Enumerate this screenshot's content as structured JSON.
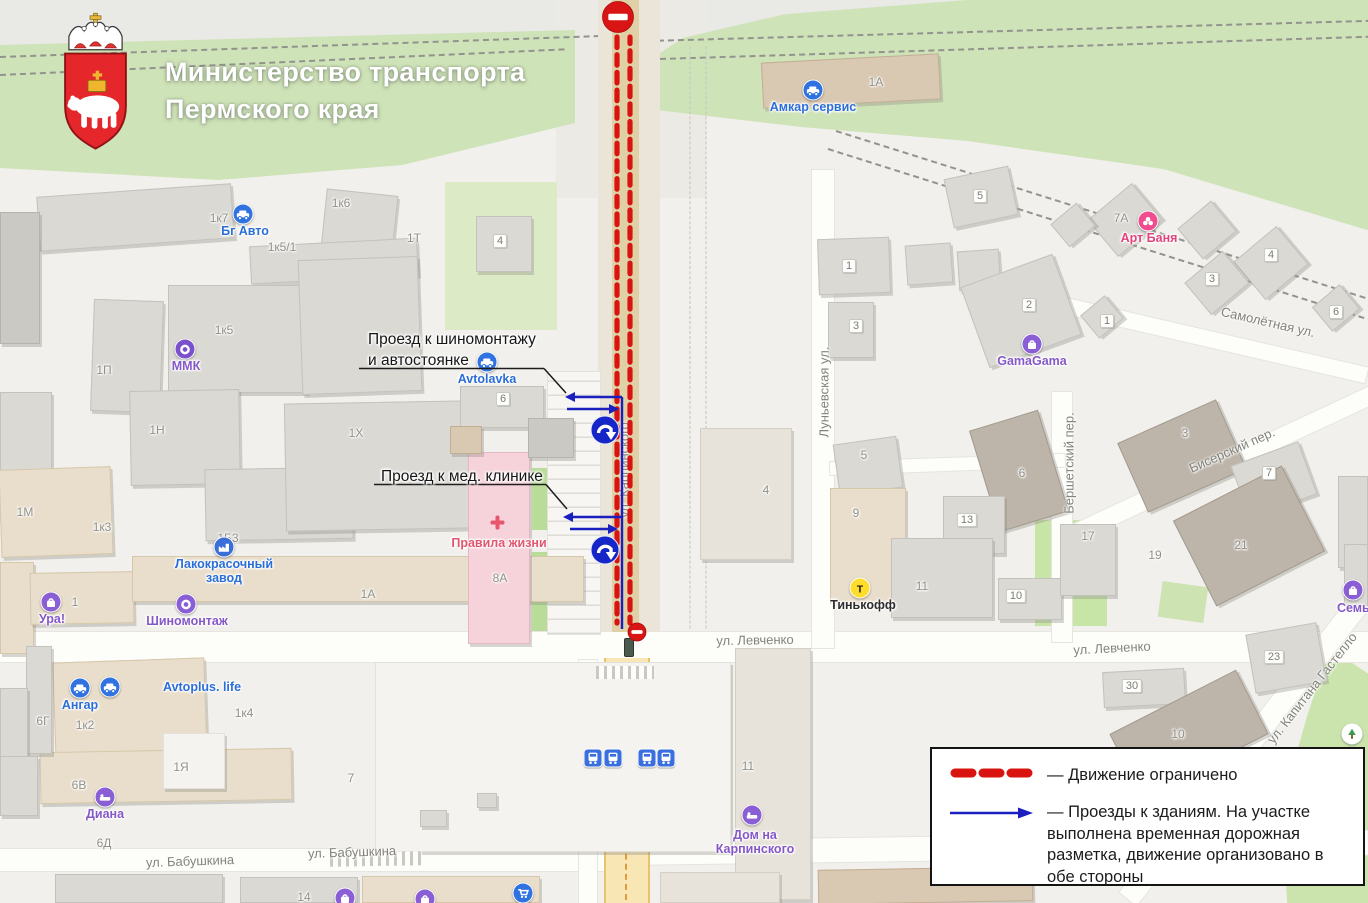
{
  "header": {
    "title_line1": "Министерство транспорта",
    "title_line2": "Пермского края",
    "emblem": "perm-krai-coat-of-arms"
  },
  "callouts": [
    {
      "lines": [
        "Проезд к шиномонтажу",
        "и автостоянке"
      ],
      "x": 368,
      "y": 329,
      "underline": [
        359,
        368.5,
        544,
        368.5
      ],
      "leader": [
        544,
        368.5,
        566,
        393
      ]
    },
    {
      "lines": [
        "Проезд к мед. клинике"
      ],
      "x": 381,
      "y": 466,
      "underline": [
        374,
        484.5,
        546,
        484.5
      ],
      "leader": [
        546,
        484.5,
        567,
        509
      ]
    }
  ],
  "legend": {
    "items": [
      {
        "symbol": "red-dashed-line",
        "label": "— Движение ограничено"
      },
      {
        "symbol": "blue-arrow",
        "label": "— Проезды к зданиям. На участке выполнена временная дорожная разметка, движение организовано в обе стороны"
      }
    ]
  },
  "colors": {
    "restricted": "#d91410",
    "access_route": "#1b1fc0",
    "sign_red": "#d81414",
    "legend_border": "#141414"
  },
  "closure": {
    "red_dash_lines": [
      {
        "x": 617,
        "y1": 37,
        "y2": 623
      },
      {
        "x": 630,
        "y1": 37,
        "y2": 623
      }
    ],
    "no_entry_signs": [
      {
        "x": 618,
        "y": 17,
        "r": 15.5
      },
      {
        "x": 637,
        "y": 632,
        "r": 9
      }
    ],
    "blue_guide_line": {
      "x": 622,
      "y1": 397,
      "y2": 629
    },
    "blue_arrows": [
      {
        "x1": 622,
        "y1": 397,
        "x2": 565,
        "y2": 397
      },
      {
        "x1": 567,
        "y1": 409,
        "x2": 619,
        "y2": 409
      },
      {
        "x1": 622,
        "y1": 517,
        "x2": 563,
        "y2": 517
      },
      {
        "x1": 570,
        "y1": 529,
        "x2": 618,
        "y2": 529
      }
    ],
    "turn_signs": [
      {
        "x": 605,
        "y": 430
      },
      {
        "x": 605,
        "y": 550
      }
    ]
  },
  "map": {
    "streets": [
      {
        "t": "ул. Левченко",
        "x": 755,
        "y": 640,
        "rot": -1
      },
      {
        "t": "ул. Левченко",
        "x": 1112,
        "y": 648,
        "rot": -3
      },
      {
        "t": "ул. Бабушкина",
        "x": 190,
        "y": 861,
        "rot": -2
      },
      {
        "t": "ул. Бабушкина",
        "x": 352,
        "y": 852,
        "rot": -2
      },
      {
        "t": "Самолётная ул.",
        "x": 1268,
        "y": 322,
        "rot": 13
      },
      {
        "t": "Луньевская ул.",
        "x": 824,
        "y": 392,
        "rot": -90
      },
      {
        "t": "Бершетский пер.",
        "x": 1069,
        "y": 463,
        "rot": -90
      },
      {
        "t": "Бисерский пер.",
        "x": 1232,
        "y": 450,
        "rot": -24
      },
      {
        "t": "ул. Капитана Гастелло",
        "x": 1312,
        "y": 688,
        "rot": -52
      },
      {
        "t": "ул. Карпинского",
        "x": 624,
        "y": 470,
        "rot": -90
      }
    ],
    "addresses": [
      {
        "t": "1к7",
        "x": 219,
        "y": 218
      },
      {
        "t": "1к6",
        "x": 341,
        "y": 203
      },
      {
        "t": "1Т",
        "x": 414,
        "y": 238
      },
      {
        "t": "1к5/1",
        "x": 282,
        "y": 247
      },
      {
        "t": "1к5",
        "x": 224,
        "y": 330
      },
      {
        "t": "1П",
        "x": 104,
        "y": 370
      },
      {
        "t": "1Н",
        "x": 157,
        "y": 430
      },
      {
        "t": "1Х",
        "x": 356,
        "y": 433
      },
      {
        "t": "1М",
        "x": 25,
        "y": 512
      },
      {
        "t": "1к3",
        "x": 102,
        "y": 527
      },
      {
        "t": "1Б3",
        "x": 228,
        "y": 538
      },
      {
        "t": "8А",
        "x": 500,
        "y": 578
      },
      {
        "t": "1А",
        "x": 368,
        "y": 594
      },
      {
        "t": "1",
        "x": 75,
        "y": 602
      },
      {
        "t": "6",
        "x": 503,
        "y": 399,
        "p": 1
      },
      {
        "t": "4",
        "x": 500,
        "y": 241,
        "p": 1
      },
      {
        "t": "1А",
        "x": 876,
        "y": 82
      },
      {
        "t": "5",
        "x": 980,
        "y": 196,
        "p": 1
      },
      {
        "t": "1",
        "x": 849,
        "y": 266,
        "p": 1
      },
      {
        "t": "3",
        "x": 856,
        "y": 326,
        "p": 1
      },
      {
        "t": "2",
        "x": 1029,
        "y": 305,
        "p": 1
      },
      {
        "t": "1",
        "x": 1107,
        "y": 321,
        "p": 1
      },
      {
        "t": "7А",
        "x": 1121,
        "y": 218
      },
      {
        "t": "4",
        "x": 1271,
        "y": 255,
        "p": 1
      },
      {
        "t": "3",
        "x": 1212,
        "y": 279,
        "p": 1
      },
      {
        "t": "6",
        "x": 1336,
        "y": 312,
        "p": 1
      },
      {
        "t": "4",
        "x": 766,
        "y": 490
      },
      {
        "t": "5",
        "x": 864,
        "y": 455
      },
      {
        "t": "6",
        "x": 1022,
        "y": 473
      },
      {
        "t": "9",
        "x": 856,
        "y": 513
      },
      {
        "t": "13",
        "x": 967,
        "y": 520,
        "p": 1
      },
      {
        "t": "11",
        "x": 922,
        "y": 586
      },
      {
        "t": "10",
        "x": 1016,
        "y": 596,
        "p": 1
      },
      {
        "t": "17",
        "x": 1088,
        "y": 536
      },
      {
        "t": "19",
        "x": 1155,
        "y": 555
      },
      {
        "t": "21",
        "x": 1241,
        "y": 545
      },
      {
        "t": "3",
        "x": 1185,
        "y": 433
      },
      {
        "t": "7",
        "x": 1269,
        "y": 473,
        "p": 1
      },
      {
        "t": "23",
        "x": 1274,
        "y": 657,
        "p": 1
      },
      {
        "t": "30",
        "x": 1132,
        "y": 686,
        "p": 1
      },
      {
        "t": "10",
        "x": 1178,
        "y": 734
      },
      {
        "t": "11",
        "x": 748,
        "y": 766
      },
      {
        "t": "6Г",
        "x": 43,
        "y": 721
      },
      {
        "t": "1к2",
        "x": 85,
        "y": 725
      },
      {
        "t": "1к4",
        "x": 244,
        "y": 713
      },
      {
        "t": "1Я",
        "x": 181,
        "y": 767
      },
      {
        "t": "6В",
        "x": 79,
        "y": 785
      },
      {
        "t": "6Д",
        "x": 104,
        "y": 843
      },
      {
        "t": "7",
        "x": 351,
        "y": 778
      },
      {
        "t": "14",
        "x": 304,
        "y": 897
      }
    ],
    "pois": [
      {
        "type": "car",
        "label": "Бг Авто",
        "ix": 243,
        "iy": 214,
        "tx": 245,
        "ty": 224
      },
      {
        "type": "car",
        "label": "Амкар сервис",
        "ix": 813,
        "iy": 90,
        "tx": 813,
        "ty": 100
      },
      {
        "type": "car",
        "label": "Avtolavka",
        "ix": 487,
        "iy": 362,
        "tx": 487,
        "ty": 372
      },
      {
        "type": "car",
        "label": "Ангар",
        "ix": 80,
        "iy": 688,
        "tx": 80,
        "ty": 698
      },
      {
        "type": "car",
        "label": "Avtoplus. life",
        "ix": 110,
        "iy": 687,
        "tx": 163,
        "ty": 680,
        "anchor": "w"
      },
      {
        "type": "factory",
        "label": "Лакокрасочный завод",
        "ix": 224,
        "iy": 547,
        "tx": 224,
        "ty": 557,
        "w": 118
      },
      {
        "type": "tire",
        "label": "Шиномонтаж",
        "ix": 186,
        "iy": 604,
        "tx": 187,
        "ty": 614
      },
      {
        "type": "shop",
        "label": "Ура!",
        "ix": 51,
        "iy": 602,
        "tx": 52,
        "ty": 612
      },
      {
        "type": "ring",
        "label": "ММК",
        "ix": 185,
        "iy": 349,
        "tx": 186,
        "ty": 359
      },
      {
        "type": "bath",
        "label": "Арт Баня",
        "ix": 1148,
        "iy": 221,
        "tx": 1149,
        "ty": 231
      },
      {
        "type": "shop",
        "label": "GamaGama",
        "ix": 1032,
        "iy": 344,
        "tx": 1032,
        "ty": 354
      },
      {
        "type": "medcross",
        "label": "Правила жизни",
        "ix": 497,
        "iy": 522,
        "tx": 499,
        "ty": 536
      },
      {
        "type": "bank",
        "label": "Тинькофф",
        "ix": 860,
        "iy": 588,
        "tx": 863,
        "ty": 598
      },
      {
        "type": "hotel",
        "label": "Диана",
        "ix": 105,
        "iy": 797,
        "tx": 105,
        "ty": 807
      },
      {
        "type": "hotel",
        "label": "Дом на Карпинского",
        "ix": 752,
        "iy": 815,
        "tx": 755,
        "ty": 828,
        "w": 112
      },
      {
        "type": "shop",
        "label": "Семья",
        "ix": 1353,
        "iy": 590,
        "tx": 1357,
        "ty": 601
      },
      {
        "type": "shop",
        "label": "",
        "ix": 345,
        "iy": 898
      },
      {
        "type": "shop",
        "label": "",
        "ix": 425,
        "iy": 899
      },
      {
        "type": "cart",
        "label": "",
        "ix": 523,
        "iy": 893
      },
      {
        "type": "tree",
        "label": "",
        "ix": 1352,
        "iy": 734
      }
    ],
    "transit_stops": [
      {
        "x": 593,
        "y": 758
      },
      {
        "x": 613,
        "y": 758
      },
      {
        "x": 647,
        "y": 758
      },
      {
        "x": 666,
        "y": 758
      }
    ]
  }
}
